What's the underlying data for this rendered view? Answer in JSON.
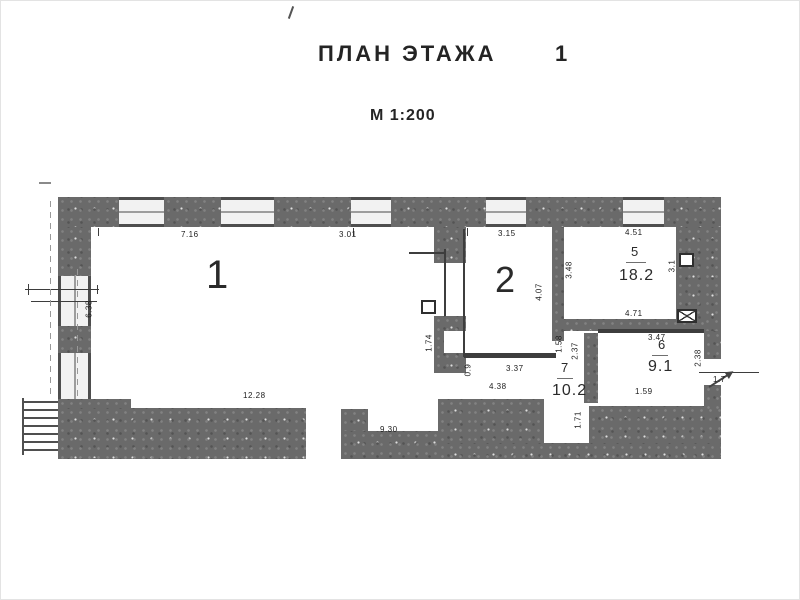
{
  "document": {
    "title": "ПЛАН ЭТАЖА",
    "floor_number": "1",
    "scale_label": "М 1:200"
  },
  "rooms": {
    "r1": {
      "number": "1"
    },
    "r2": {
      "number": "2"
    },
    "r5": {
      "number": "5",
      "area": "18.2"
    },
    "r6": {
      "number": "6",
      "area": "9.1"
    },
    "r7": {
      "number": "7",
      "area": "10.2"
    }
  },
  "dimensions": {
    "room1_top_left": "7.16",
    "room1_top_right": "3.01",
    "room1_left": "6.38",
    "room1_bottom": "12.28",
    "room1_bottom_right": "9.30",
    "room1_niche_right": "1.74",
    "room2_top": "3.15",
    "room2_right": "4.07",
    "room5_top": "4.51",
    "room5_left": "3.48",
    "room5_bottom": "4.71",
    "room5_right": "3.1",
    "room6_top": "3.47",
    "room6_bottom": "1.59",
    "room6_right": "2.38",
    "room7_top": "3.37",
    "room7_bottom": "4.38",
    "room7_left": "0.9",
    "hall_width": "1.58",
    "hall_depth": "2.37",
    "exit_passage": "1.71",
    "exit_right": "1.7"
  }
}
